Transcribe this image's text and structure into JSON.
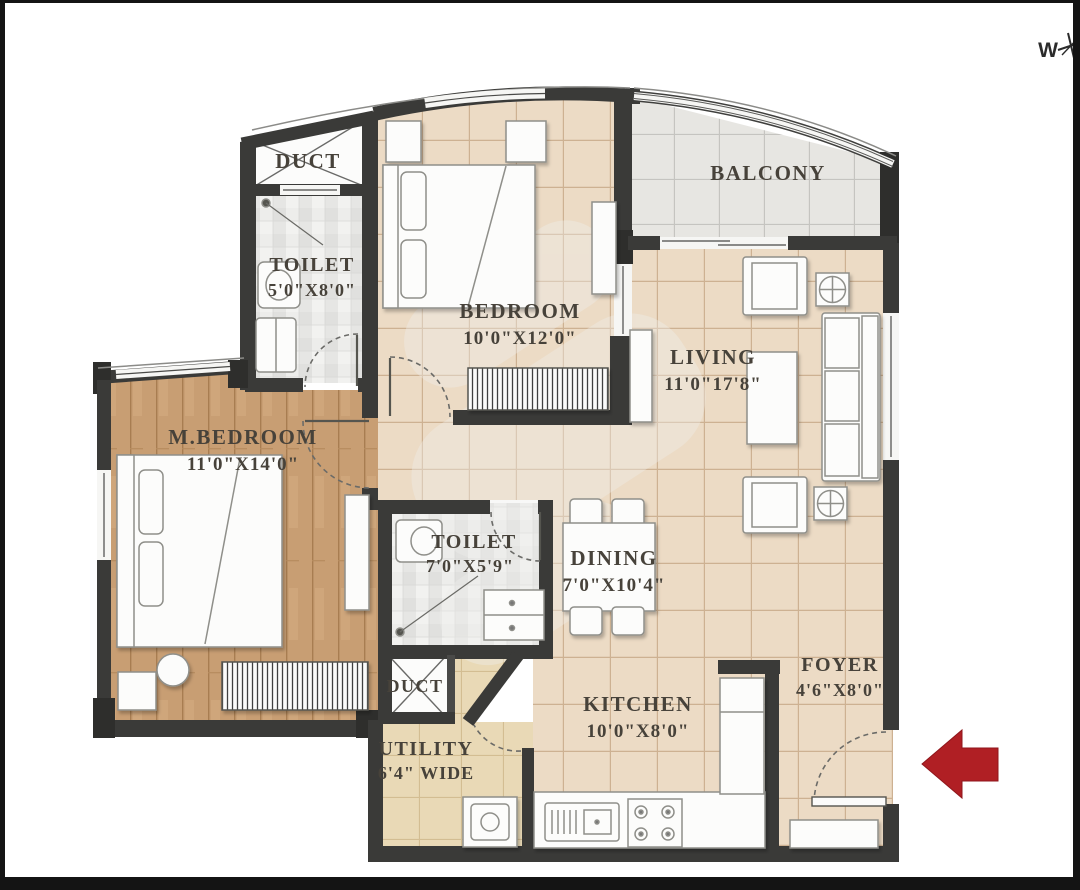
{
  "compass": {
    "west": "W"
  },
  "rooms": {
    "duct_top": {
      "name": "DUCT"
    },
    "toilet_top": {
      "name": "TOILET",
      "dims": "5'0\"X8'0\""
    },
    "bedroom": {
      "name": "BEDROOM",
      "dims": "10'0\"X12'0\""
    },
    "balcony": {
      "name": "BALCONY"
    },
    "living": {
      "name": "LIVING",
      "dims": "11'0\"17'8\""
    },
    "m_bedroom": {
      "name": "M.BEDROOM",
      "dims": "11'0\"X14'0\""
    },
    "toilet_mid": {
      "name": "TOILET",
      "dims": "7'0\"X5'9\""
    },
    "dining": {
      "name": "DINING",
      "dims": "7'0\"X10'4\""
    },
    "duct_bottom": {
      "name": "DUCT"
    },
    "utility": {
      "name": "UTILITY",
      "dims": "6'4\" WIDE"
    },
    "kitchen": {
      "name": "KITCHEN",
      "dims": "10'0\"X8'0\""
    },
    "foyer": {
      "name": "FOYER",
      "dims": "4'6\"X8'0\""
    }
  },
  "colors": {
    "wall": "#3a3a38",
    "floor_tile": "#ecdbc5",
    "wood_floor": "#c89e73",
    "balcony_tile": "#e7e6e2",
    "mosaic_tile": "#ececea",
    "utility_tile": "#e9d9b6",
    "entrance_arrow": "#b01f24"
  }
}
